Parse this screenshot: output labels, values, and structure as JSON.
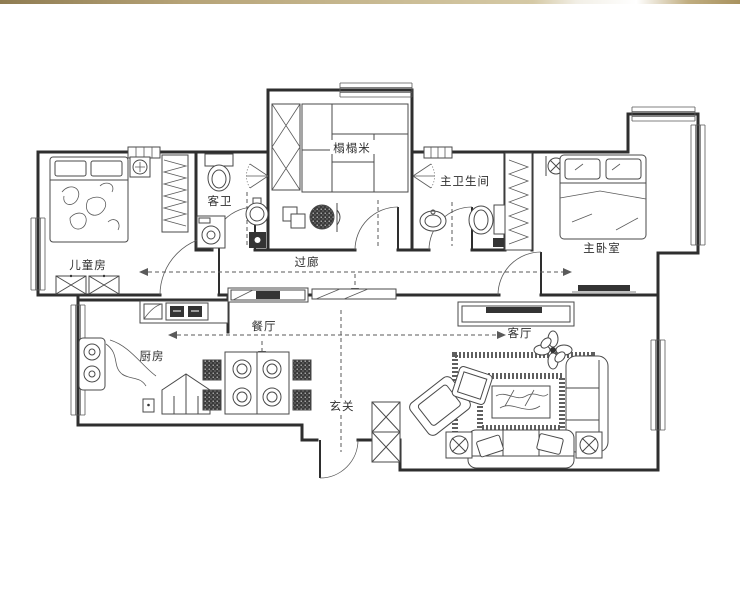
{
  "rooms": {
    "children": {
      "label": "儿童房"
    },
    "guest_bath": {
      "label": "客卫"
    },
    "tatami": {
      "label": "榻榻米"
    },
    "master_bath": {
      "label": "主卫生间"
    },
    "master_bedroom": {
      "label": "主卧室"
    },
    "corridor": {
      "label": "过廊"
    },
    "kitchen": {
      "label": "厨房"
    },
    "dining": {
      "label": "餐厅"
    },
    "living": {
      "label": "客厅"
    },
    "entry": {
      "label": "玄关"
    }
  },
  "colors": {
    "wall": "#2e2e2e",
    "furniture_line": "#4a4a4a",
    "axis_dashed": "#5a5a5a",
    "dark_fill": "#343434",
    "background": "#ffffff",
    "banner_gold": "#b6a377"
  },
  "icons": {
    "bed": "rect-with-pillows",
    "wardrobe": "hatched-rect",
    "toilet": "oval-with-tank",
    "sink": "circle-basin",
    "washing_machine": "square-with-drum",
    "shower": "spray-fan",
    "dining_table": "square-4-plates",
    "sofa": "rounded-rect-cushions",
    "coffee_table": "bordered-rect",
    "tv": "dark-bar",
    "plant": "petal-flower",
    "lamp": "circle-on-square",
    "shoe_cabinet": "x-box",
    "door": "quarter-arc",
    "window": "parallel-lines"
  }
}
